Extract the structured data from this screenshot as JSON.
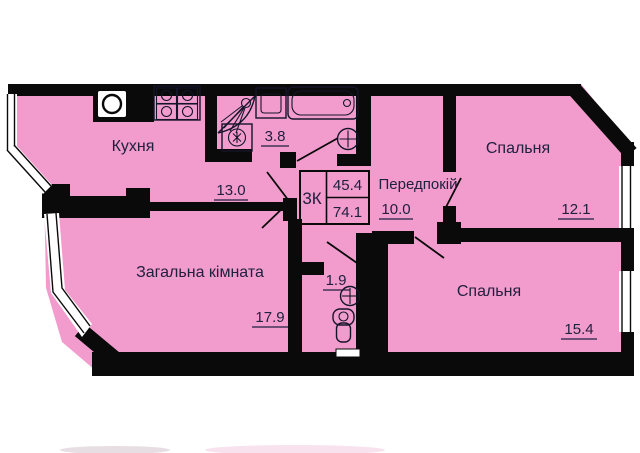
{
  "plan": {
    "unit": {
      "type_label": "3К",
      "living_area": "45.4",
      "total_area": "74.1"
    },
    "rooms": {
      "kitchen": {
        "name": "Кухня",
        "area": "13.0"
      },
      "living": {
        "name": "Загальна кімната",
        "area": "17.9"
      },
      "bedroom1": {
        "name": "Спальня",
        "area": "12.1"
      },
      "bedroom2": {
        "name": "Спальня",
        "area": "15.4"
      },
      "hallway": {
        "name": "Передпокій",
        "area": "10.0"
      },
      "bathroom": {
        "area": "3.8"
      },
      "wc": {
        "area": "1.9"
      }
    },
    "colors": {
      "room_fill": "#f29ccd",
      "wall": "#0a0a0a",
      "label_text": "#20203f",
      "background": "#ffffff"
    }
  }
}
